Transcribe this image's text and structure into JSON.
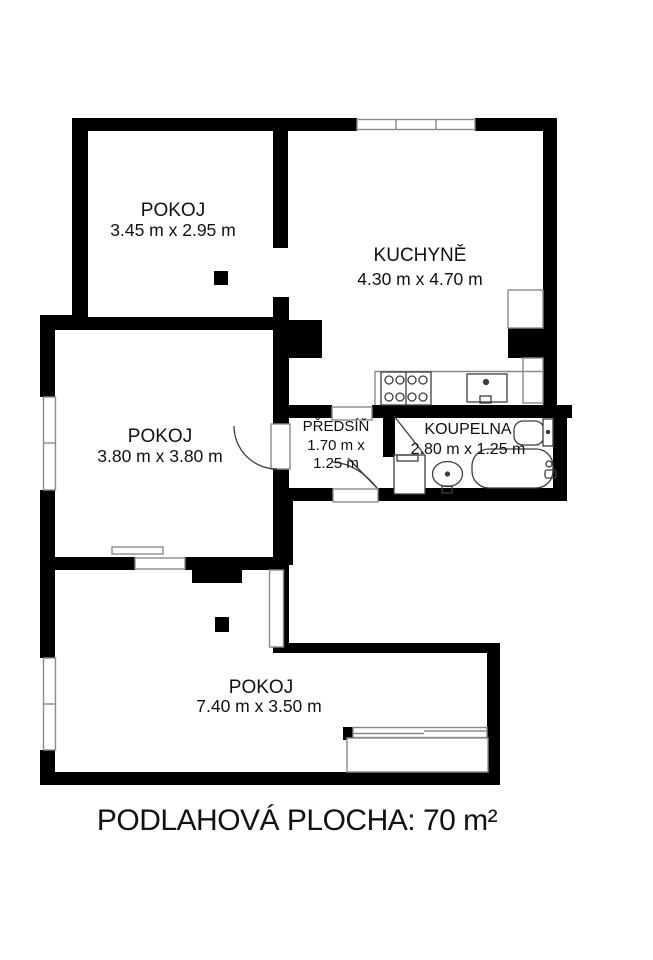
{
  "title": "PODLAHOVÁ PLOCHA: 70 m²",
  "rooms": [
    {
      "name": "POKOJ",
      "dims": "3.45 m x 2.95 m"
    },
    {
      "name": "KUCHYNĚ",
      "dims": "4.30 m x 4.70 m"
    },
    {
      "name": "POKOJ",
      "dims": "3.80 m x 3.80 m"
    },
    {
      "name": "PŘEDSÍŇ",
      "dims1": "1.70 m x",
      "dims2": "1.25 m"
    },
    {
      "name": "KOUPELNA",
      "dims": "2.80 m x 1.25 m"
    },
    {
      "name": "POKOJ",
      "dims": "7.40 m x 3.50 m"
    }
  ],
  "colors": {
    "wall": "#000000",
    "background": "#ffffff",
    "fixture_outline": "#8a8a8a",
    "fixture_dark": "#3d3d3d",
    "text": "#111111"
  },
  "fixtures": [
    "stove",
    "kitchen-sink",
    "counter",
    "niche",
    "duct",
    "bathtub",
    "washbasin",
    "toilet",
    "washing-machine",
    "radiator",
    "chimney-flue",
    "wardrobe-shaft",
    "loggia",
    "window",
    "door-swing"
  ]
}
